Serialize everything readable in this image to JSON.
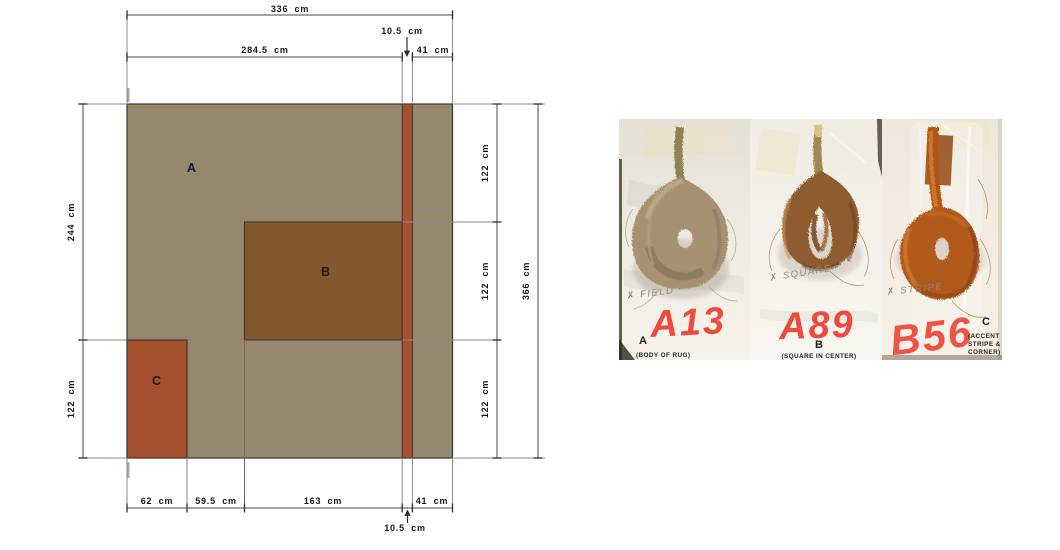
{
  "diagram": {
    "colors": {
      "body": "#96876F",
      "square": "#84582E",
      "accent": "#A5502F"
    },
    "regions": {
      "a": "A",
      "b": "B",
      "c": "C"
    },
    "dims": {
      "total_width": "336 cm",
      "top_left": "284.5 cm",
      "stripe_top": "10.5 cm",
      "top_right": "41 cm",
      "left_upper": "244 cm",
      "left_lower": "122 cm",
      "right_1": "122 cm",
      "right_2": "122 cm",
      "right_3": "122 cm",
      "total_height": "366 cm",
      "bottom_1": "62 cm",
      "bottom_2": "59.5 cm",
      "bottom_3": "163 cm",
      "bottom_4": "41 cm",
      "stripe_bottom": "10.5 cm"
    }
  },
  "samples": [
    {
      "code": "A13",
      "letter": "A",
      "note": "✗ FIELD",
      "caption_lines": [
        "(BODY OF RUG)"
      ],
      "yarn_color": "#A69170",
      "marker_color": "#EE4A3E"
    },
    {
      "code": "A89",
      "letter": "B",
      "note": "✗ SQUARE",
      "caption_lines": [
        "(SQUARE IN CENTER)"
      ],
      "yarn_color": "#8E5C2D",
      "marker_color": "#EE4A3E"
    },
    {
      "code": "B56",
      "letter": "C",
      "note": "✗ STRIPE",
      "caption_lines": [
        "(ACCENT",
        "STRIPE &",
        "CORNER)"
      ],
      "yarn_color": "#B25A1C",
      "marker_color": "#EE5347"
    }
  ]
}
